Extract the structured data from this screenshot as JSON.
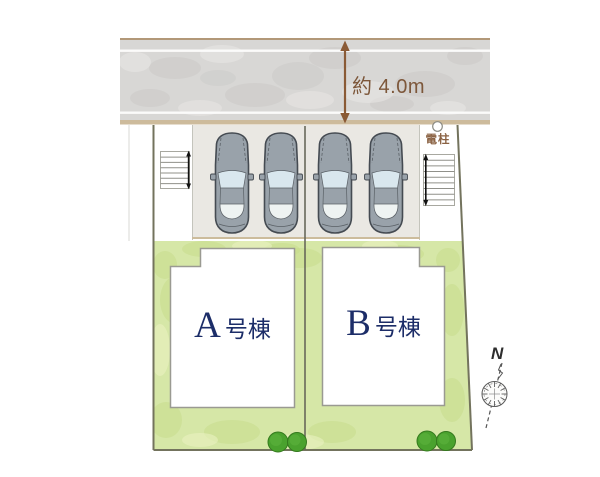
{
  "road": {
    "width_label": "約 4.0m"
  },
  "parking": {
    "car_count": 4
  },
  "buildings": [
    {
      "letter": "A",
      "suffix": "号棟",
      "label": "A号棟"
    },
    {
      "letter": "B",
      "suffix": "号棟",
      "label": "B号棟"
    }
  ],
  "annotations": {
    "utility_pole": "電柱",
    "compass_north": "N"
  },
  "colors": {
    "road_surface": "#d8d7d5",
    "road_edge": "#b29878",
    "dimension_text": "#7d573a",
    "grass": "#d6e7a7",
    "bush": "#4aa22e",
    "building_label": "#1c2d68",
    "car_body": "#99a2aa",
    "boundary": "#73735d"
  }
}
